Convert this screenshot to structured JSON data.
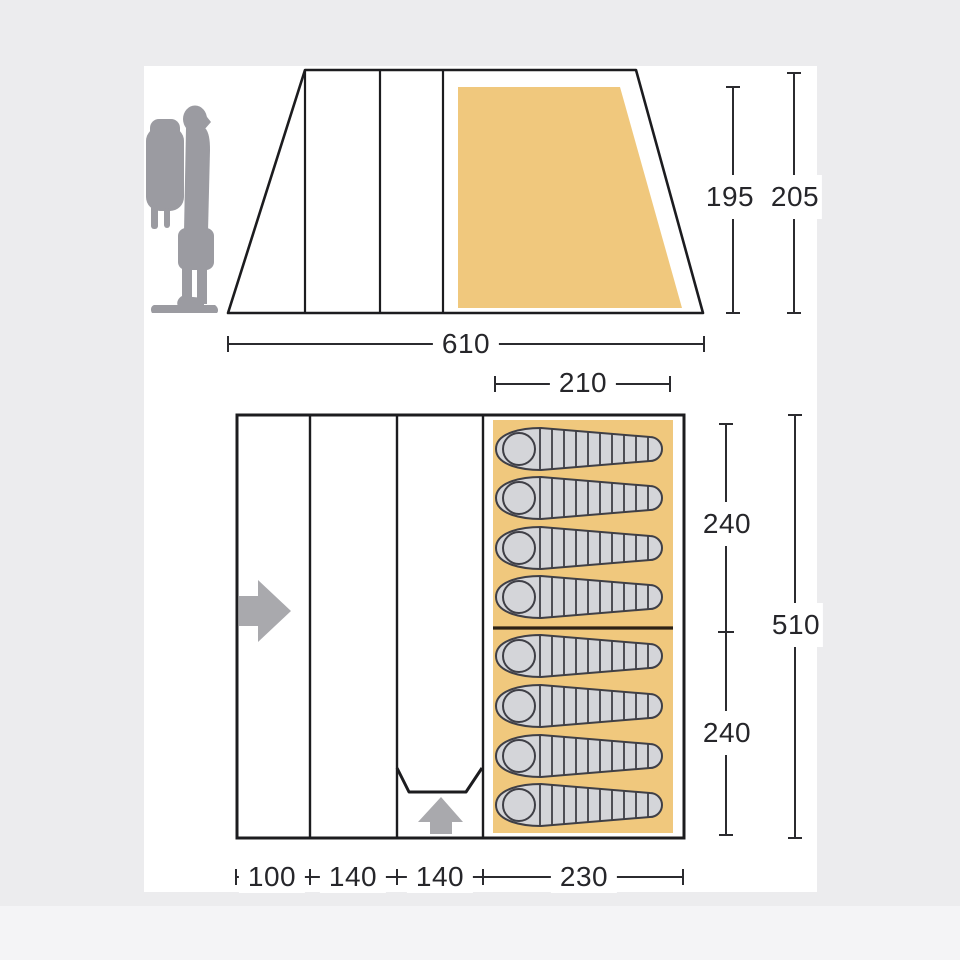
{
  "scene": {
    "title": "Tent dimensions diagram",
    "background_color": "#ececee",
    "panel_color": "#ffffff"
  },
  "colors": {
    "tent_outline": "#1c1c1f",
    "dimension_line": "#2b2b2f",
    "label_text": "#26262a",
    "groundsheet_orange": "#f0c87d",
    "sleeping_bag_fill": "#d4d5d9",
    "sleeping_bag_outline": "#3f3f46",
    "bedroom_divider": "#2c2115",
    "figure_gray": "#9b9ba1",
    "arrow_gray": "#a9a9ad"
  },
  "side_view": {
    "labels": {
      "inner_height": "195",
      "total_height": "205",
      "total_length": "610",
      "bedroom_length": "210"
    }
  },
  "floor_plan": {
    "labels": {
      "bedroom_depth_upper": "240",
      "total_depth": "510",
      "bedroom_depth_lower": "240",
      "porch_length": "100",
      "living_length_a": "140",
      "living_length_b": "140",
      "bedroom_length": "230"
    },
    "sleeping_bag_count": 8,
    "entrances": [
      "side-entrance-right-arrow",
      "front-entrance-up-arrow"
    ]
  }
}
